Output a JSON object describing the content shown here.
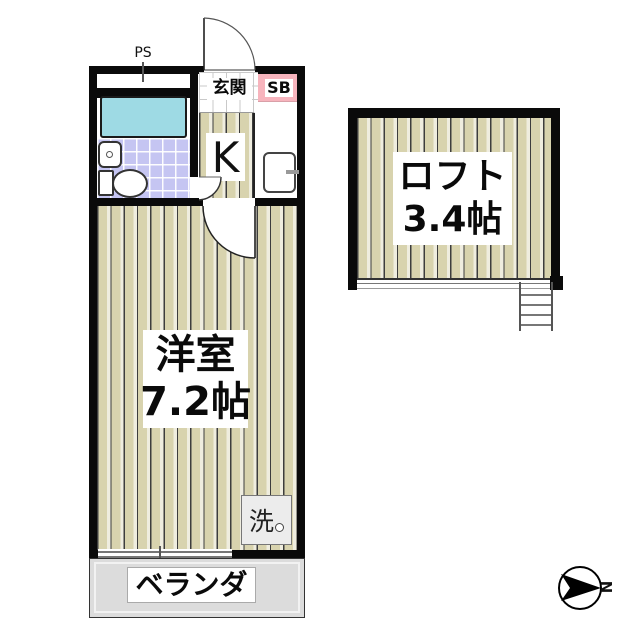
{
  "rooms": {
    "pipe_space": {
      "label": "PS"
    },
    "entrance": {
      "label": "玄関"
    },
    "shoe_box": {
      "label": "SB"
    },
    "kitchen": {
      "label": "K"
    },
    "western_room": {
      "name": "洋室",
      "size": "7.2帖"
    },
    "loft": {
      "name": "ロフト",
      "size": "3.4帖"
    },
    "laundry": {
      "label": "洗"
    },
    "veranda": {
      "label": "ベランダ"
    }
  },
  "compass": {
    "north_label": "N"
  },
  "colors": {
    "wall": "#0a0a0a",
    "floor_stripe": "#d8d3ae",
    "floor_stripe_gap": "#efeddf",
    "bath_tile": "#c5c5f2",
    "bathtub": "#9edae4",
    "shoe_box_pink": "#f7b4bd",
    "veranda_gray": "#dcdcdc",
    "laundry_gray": "#ececec"
  }
}
